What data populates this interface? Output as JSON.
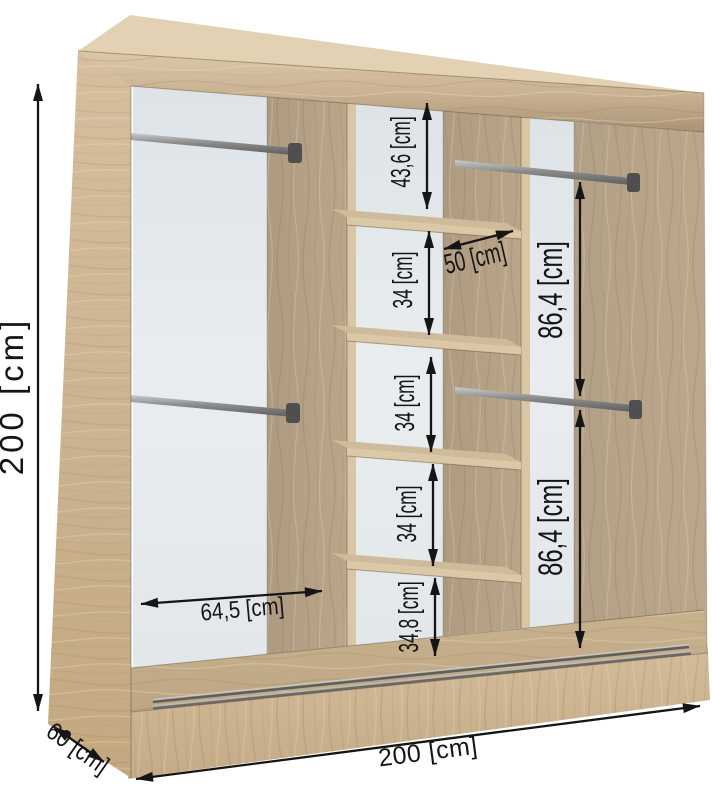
{
  "diagram": {
    "kind": "wardrobe-dimension-diagram",
    "colors": {
      "background": "#ffffff",
      "wood_light": "#cdb593",
      "wood_medium": "#b3a086",
      "wood_top": "#e2d2b3",
      "back_panel": "#e7ebee",
      "metal": "#8f8f8f",
      "dimension_ink": "#151515"
    },
    "dimensions": {
      "total_height": "200 [cm]",
      "total_width": "200 [cm]",
      "depth": "60 [cm]",
      "shelf_column_width": "50 [cm]",
      "left_section_width": "64,5 [cm]",
      "upper_hanging_height": "86,4 [cm]",
      "lower_hanging_height": "86,4 [cm]",
      "shelf_space_top": "43,6 [cm]",
      "shelf_space_2": "34 [cm]",
      "shelf_space_3": "34 [cm]",
      "shelf_space_4": "34 [cm]",
      "shelf_space_bottom": "34,8 [cm]"
    }
  }
}
